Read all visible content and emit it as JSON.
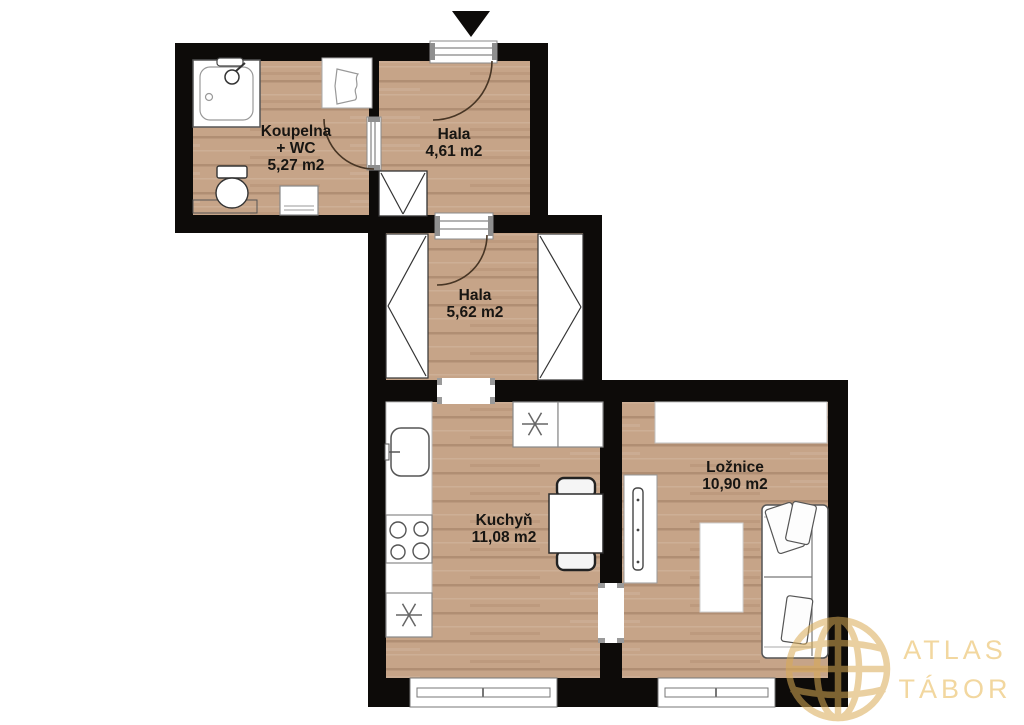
{
  "rooms": {
    "koupelna": {
      "name": "Koupelna",
      "name2": "+ WC",
      "area": "5,27 m2"
    },
    "hala_top": {
      "name": "Hala",
      "area": "4,61 m2"
    },
    "hala_mid": {
      "name": "Hala",
      "area": "5,62 m2"
    },
    "kuchyn": {
      "name": "Kuchyň",
      "area": "11,08 m2"
    },
    "loznice": {
      "name": "Ložnice",
      "area": "10,90 m2"
    }
  },
  "watermark": {
    "line1": "ATLAS",
    "line2": "TÁBOR"
  },
  "colors": {
    "wall": "#0d0b09",
    "floor": "#c6a488",
    "logo_gold": "#d9ab55",
    "logo_text": "#f2d79f"
  }
}
